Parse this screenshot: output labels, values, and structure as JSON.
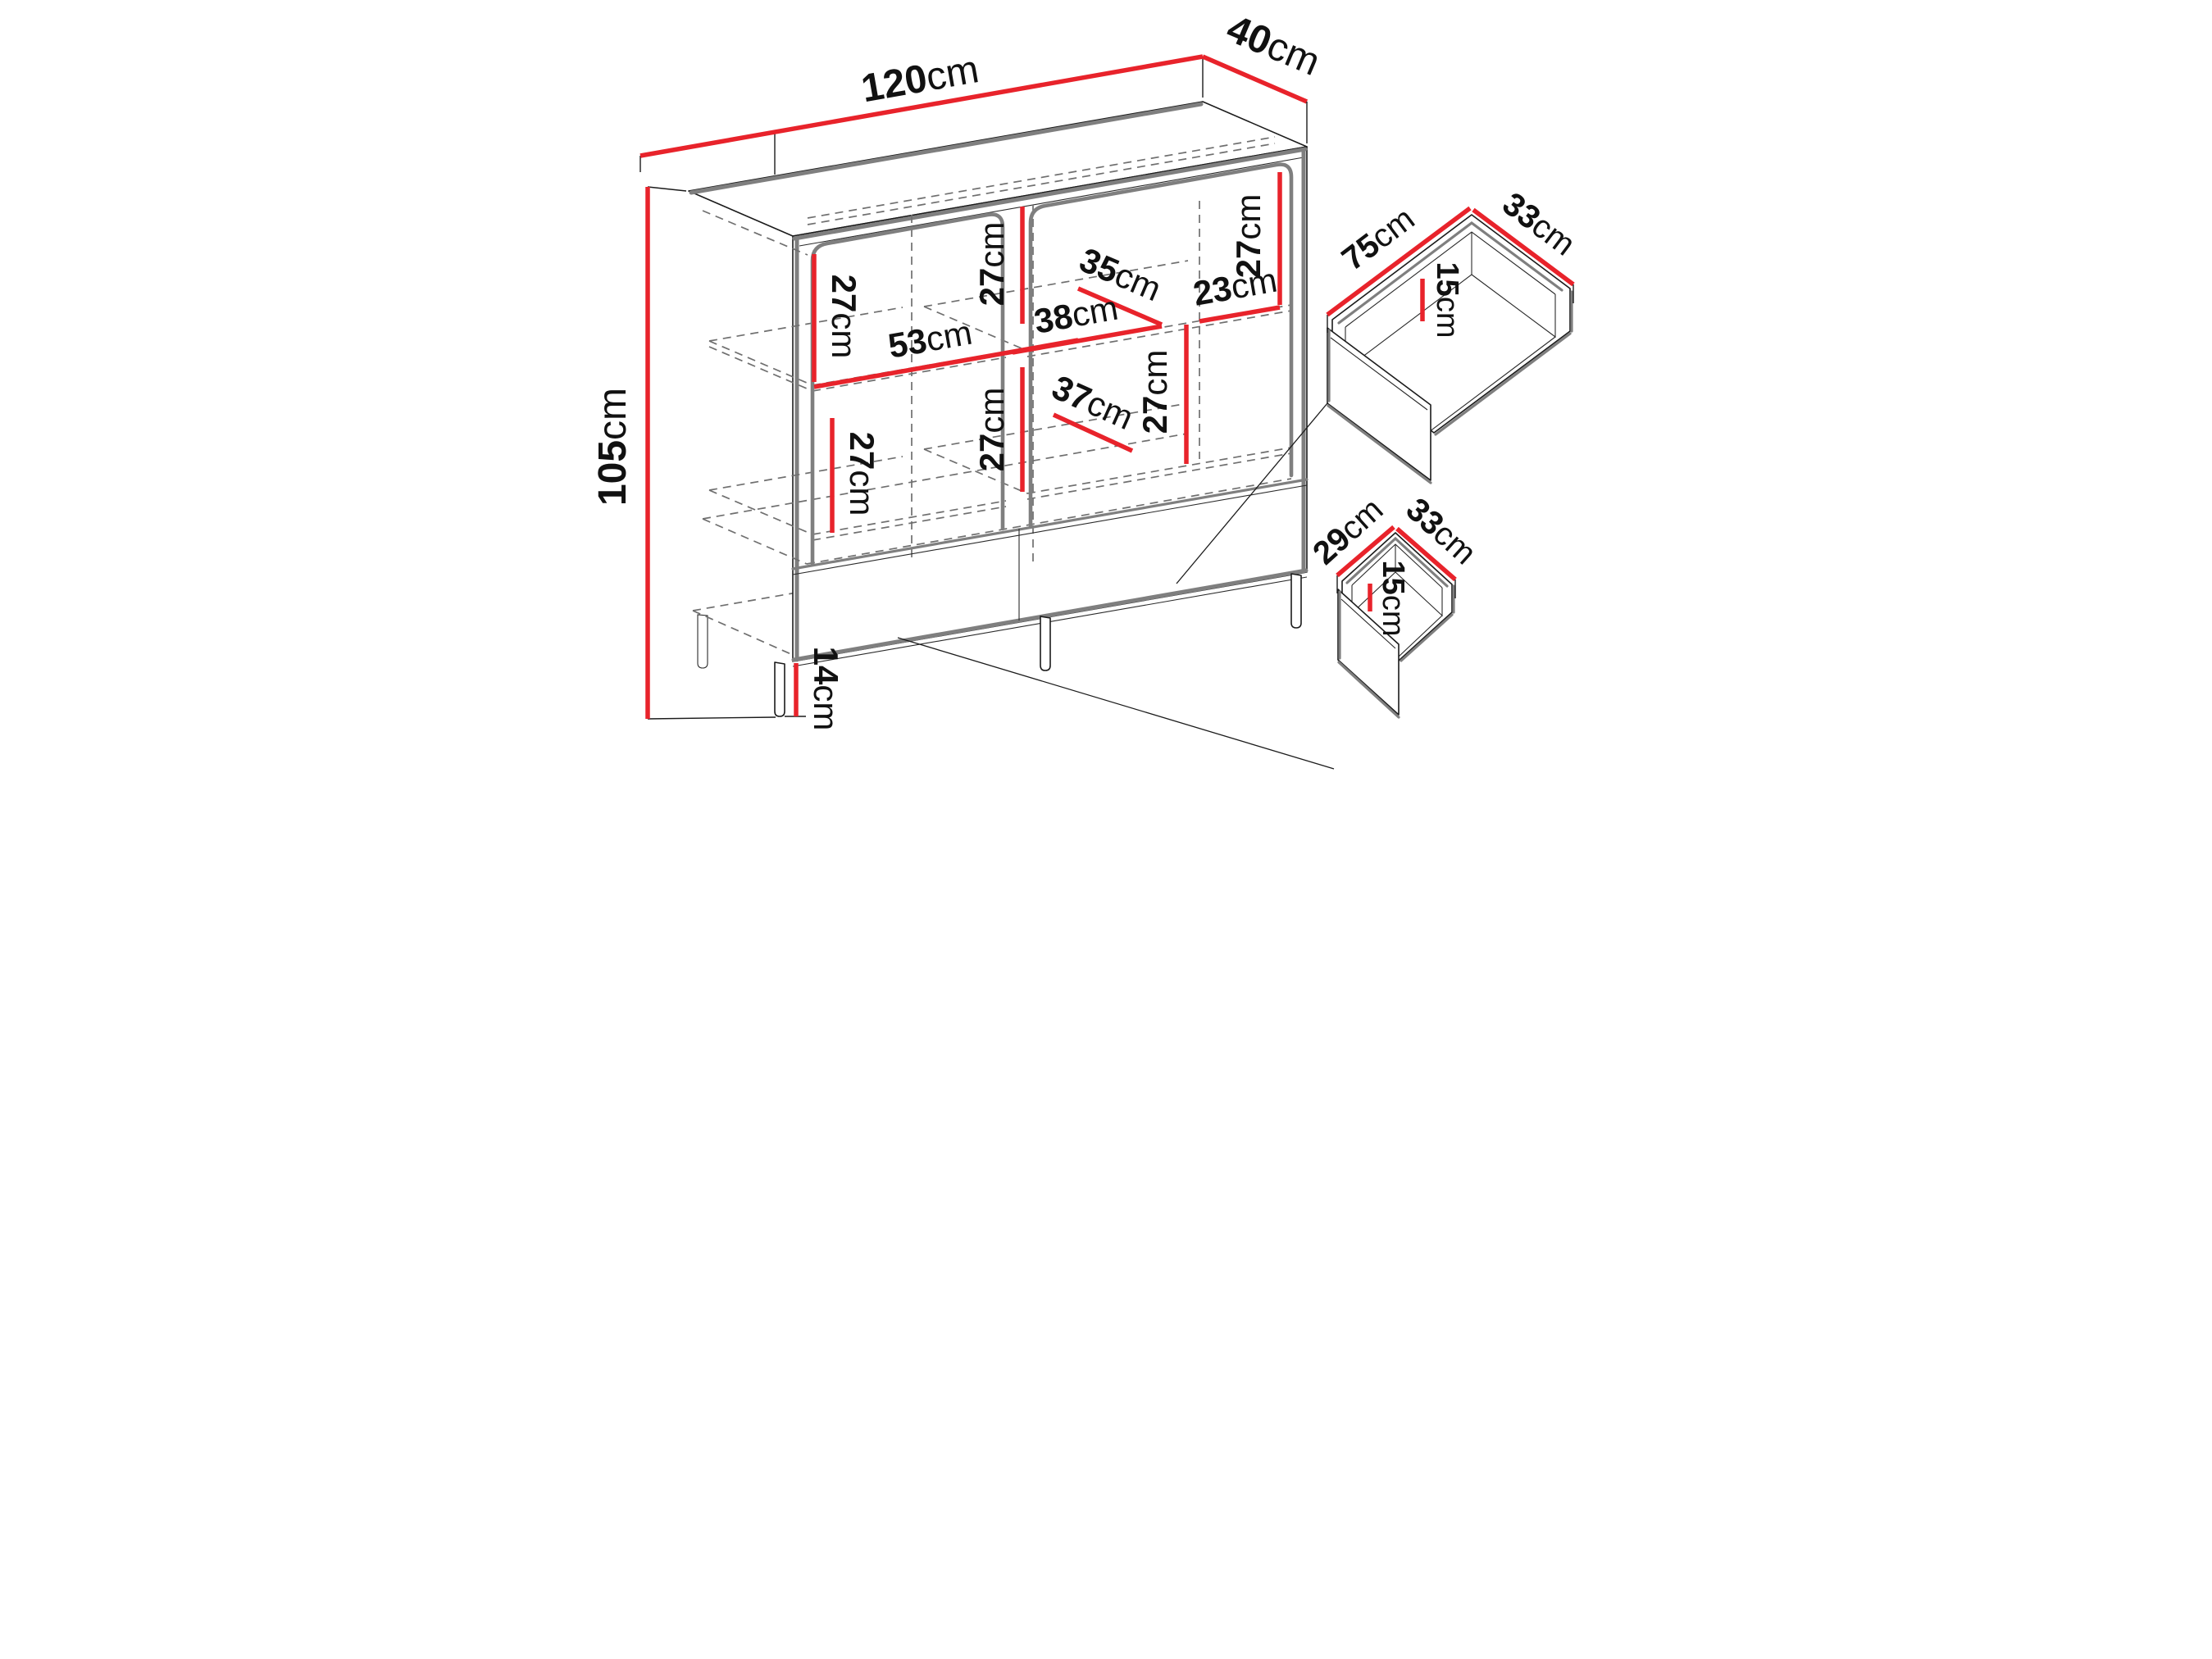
{
  "diagram": {
    "type": "furniture-dimension-drawing",
    "unit": "cm",
    "colors": {
      "background": "#ffffff",
      "dimension_line": "#e8232b",
      "outline": "#1b1b1b",
      "shadow_gray": "#7f7f7f",
      "hidden_line_gray": "#6f6f6f",
      "label_text": "#111111"
    },
    "cab": {
      "width": {
        "v": "120",
        "u": "cm"
      },
      "depth": {
        "v": "40",
        "u": "cm"
      },
      "height": {
        "v": "105",
        "u": "cm"
      },
      "leg": {
        "v": "14",
        "u": "cm"
      }
    },
    "interior": {
      "left_upper_height": {
        "v": "27",
        "u": "cm"
      },
      "left_lower_height": {
        "v": "27",
        "u": "cm"
      },
      "left_shelf_width": {
        "v": "53",
        "u": "cm"
      },
      "center_upper_height": {
        "v": "27",
        "u": "cm"
      },
      "center_lower_height": {
        "v": "27",
        "u": "cm"
      },
      "right_upper_height": {
        "v": "27",
        "u": "cm"
      },
      "right_lower_height": {
        "v": "27",
        "u": "cm"
      },
      "middle_shelf_width": {
        "v": "38",
        "u": "cm"
      },
      "upper_shelf_depth": {
        "v": "35",
        "u": "cm"
      },
      "right_shelf_width": {
        "v": "23",
        "u": "cm"
      },
      "lower_shelf_depth": {
        "v": "37",
        "u": "cm"
      }
    },
    "drawer_large": {
      "width": {
        "v": "75",
        "u": "cm"
      },
      "depth": {
        "v": "33",
        "u": "cm"
      },
      "height": {
        "v": "15",
        "u": "cm"
      }
    },
    "drawer_small": {
      "width": {
        "v": "29",
        "u": "cm"
      },
      "depth": {
        "v": "33",
        "u": "cm"
      },
      "height": {
        "v": "15",
        "u": "cm"
      }
    }
  }
}
